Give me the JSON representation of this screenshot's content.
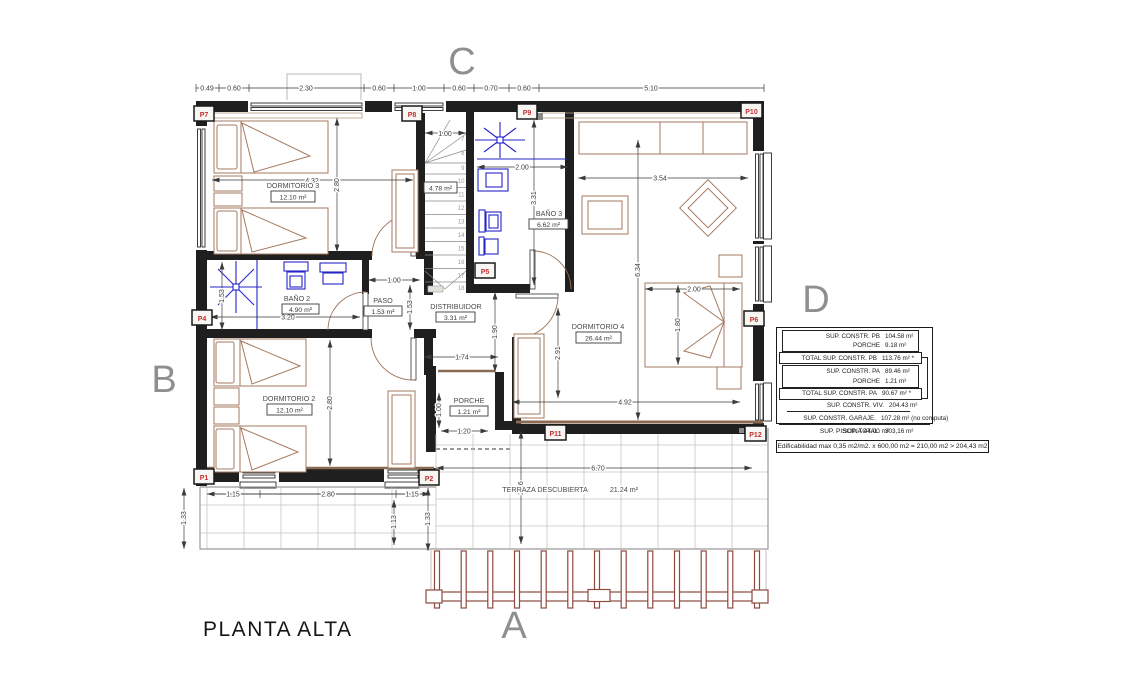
{
  "title": "PLANTA ALTA",
  "letters": {
    "a": "A",
    "b": "B",
    "c": "C",
    "d": "D"
  },
  "rooms": {
    "dormitorio3": {
      "name": "DORMITORIO 3",
      "area": "12.10 m²"
    },
    "dormitorio2": {
      "name": "DORMITORIO 2",
      "area": "12.10 m²"
    },
    "dormitorio4": {
      "name": "DORMITORIO 4",
      "area": "26.44 m²"
    },
    "bano2": {
      "name": "BAÑO 2",
      "area": "4.90 m²"
    },
    "bano3": {
      "name": "BAÑO 3",
      "area": "6.62 m²"
    },
    "paso": {
      "name": "PASO",
      "area": "1.53 m²"
    },
    "distribuidor": {
      "name": "DISTRIBUIDOR",
      "area": "3.31 m²"
    },
    "porche": {
      "name": "PORCHE",
      "area": "1.21 m²"
    },
    "escalera": {
      "area": "4.78 m²"
    },
    "terraza": {
      "name": "TERRAZA DESCUBIERTA",
      "area": "21.24 m²"
    }
  },
  "stairs": {
    "steps": [
      "7",
      "8",
      "9",
      "10",
      "11",
      "12",
      "13",
      "14",
      "15",
      "16",
      "17",
      "18"
    ]
  },
  "markers": {
    "p1": "P1",
    "p2": "P2",
    "p4": "P4",
    "p5": "P5",
    "p6": "P6",
    "p7": "P7",
    "p8": "P8",
    "p9": "P9",
    "p10": "P10",
    "p11": "P11",
    "p12": "P12"
  },
  "dims": {
    "top": [
      "0.49",
      "0.60",
      "2.30",
      "0.60",
      "1.00",
      "0.60",
      "0.70",
      "0.60",
      "5.10"
    ],
    "dorm3_w": "4.32",
    "dorm3_h": "2.80",
    "stair_w": "1.00",
    "bano3_w": "2.00",
    "bano3_h": "3.31",
    "dorm4_w": "3.54",
    "dorm4_h": "6.34",
    "bed_w": "2.00",
    "bed_h": "1.80",
    "dorm4_side": "2.91",
    "dorm4_bottom": "4.92",
    "bano2_h": "1.53",
    "bano2_w": "3.20",
    "paso_w": "1.00",
    "paso_h": "1.53",
    "dist_h": "1.90",
    "dist_w": "1.74",
    "dorm2_h": "2.80",
    "porche_h": "1.00",
    "porche_w": "1.20",
    "bottom": [
      "1.15",
      "2.80",
      "1.15"
    ],
    "left_v": "1.33",
    "mid_v": "1.13",
    "right_v": "1.33",
    "terraza_w": "6.70",
    "terraza_h": "2.16"
  },
  "summary_table": {
    "rows": [
      {
        "label": "SUP. CONSTR. PB",
        "value": "104.58 m²"
      },
      {
        "label": "PORCHE",
        "value": "9.18 m²"
      },
      {
        "label": "TOTAL SUP. CONSTR. PB",
        "value": "113.76 m²  *"
      },
      {
        "label": "SUP. CONSTR. PA",
        "value": "89.46 m²"
      },
      {
        "label": "PORCHE",
        "value": "1.21 m²"
      },
      {
        "label": "TOTAL SUP. CONSTR. PA",
        "value": "90.67 m²  *"
      },
      {
        "label": "SUP. CONSTR. VIV.",
        "value": "204.43 m²"
      },
      {
        "label": "SUP. CONSTR. GARAJE.",
        "value": "107.28 m² (no computa)"
      },
      {
        "label": "SUP. TOTAL.",
        "value": "303,16 m²"
      }
    ],
    "piscina": "SUP. PISCINA  44.00 m²",
    "edificabilidad": "Edificabilidad max  0,35 m2/m2. x 600,00 m2 = 210,00 m2 > 204,43 m2"
  },
  "colors": {
    "wall": "#1f1f1f",
    "furniture": "#a5795f",
    "fixtures": "#2525c8",
    "marker_text": "#c03030",
    "section_letter": "#8f8f8f",
    "pergola": "#8e4a3e"
  }
}
